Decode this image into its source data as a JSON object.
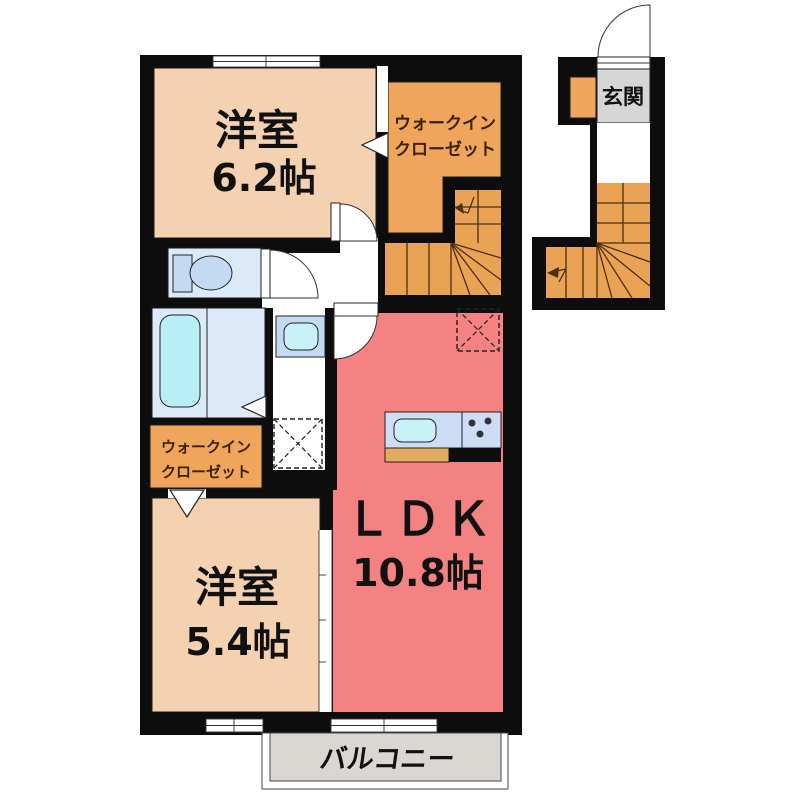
{
  "plan": {
    "rooms": {
      "bedroom1": {
        "label": "洋室",
        "size": "6.2帖"
      },
      "bedroom2": {
        "label": "洋室",
        "size": "5.4帖"
      },
      "ldk": {
        "label": "ＬＤＫ",
        "size": "10.8帖"
      },
      "wic_upper": {
        "label_line1": "ウォークイン",
        "label_line2": "クローゼット"
      },
      "wic_lower": {
        "label_line1": "ウォークイン",
        "label_line2": "クローゼット"
      },
      "entrance": {
        "label": "玄関"
      },
      "balcony": {
        "label": "バルコニー"
      }
    },
    "colors": {
      "wall": "#0d0d0d",
      "bedroom": "#f4d1b0",
      "closet": "#f0a55c",
      "stairs": "#eaa355",
      "ldk": "#f48282",
      "bath": "#dbe9f9",
      "tub": "#b8eef5",
      "fixture": "#c4d9f2",
      "sink": "#c9f2f8",
      "kitchen_counter": "#ccddf5",
      "cabinet": "#e3ab5f",
      "genkan_floor": "#d6d6d6",
      "balcony_floor": "#dad7d2"
    }
  }
}
